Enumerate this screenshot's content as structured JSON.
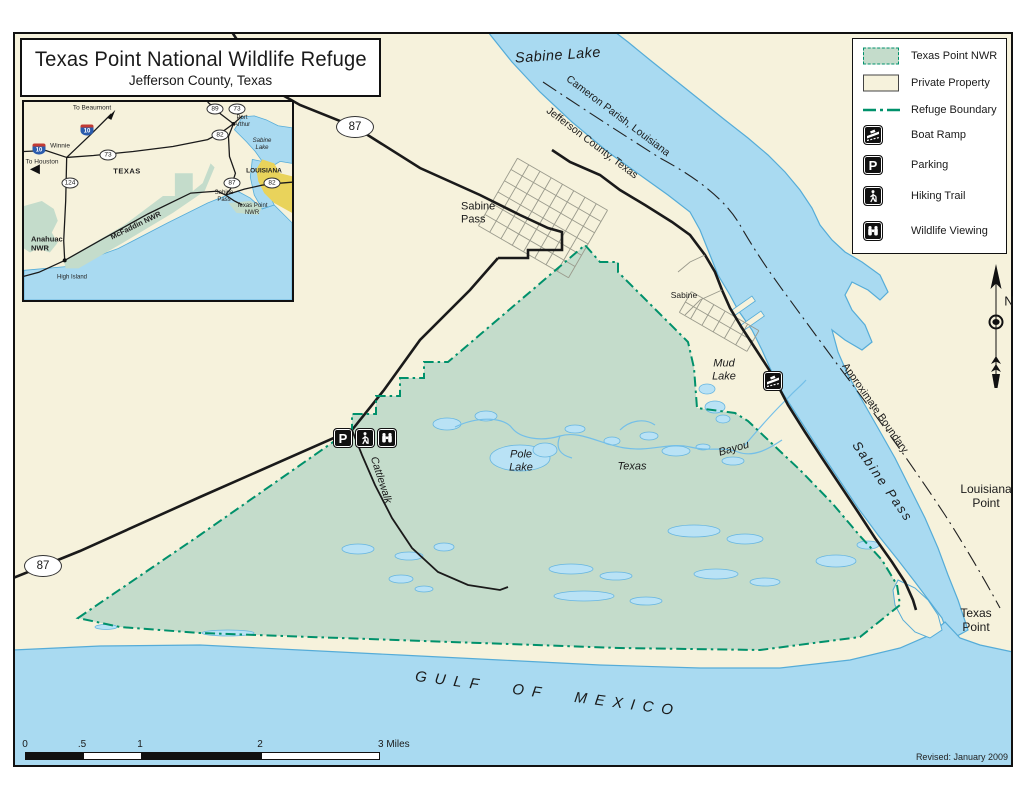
{
  "title": {
    "line1": "Texas Point National Wildlife Refuge",
    "line2": "Jefferson County, Texas"
  },
  "legend": {
    "items": [
      {
        "label": "Texas Point NWR"
      },
      {
        "label": "Private Property"
      },
      {
        "label": "Refuge Boundary"
      },
      {
        "label": "Boat Ramp"
      },
      {
        "label": "Parking"
      },
      {
        "label": "Hiking Trail"
      },
      {
        "label": "Wildlife Viewing"
      }
    ]
  },
  "compass": {
    "north_label": "N"
  },
  "scale_bar": {
    "ticks": [
      "0",
      ".5",
      "1",
      "2"
    ],
    "end_label": "3 Miles"
  },
  "icons": {
    "parking_glyph": "P"
  },
  "map": {
    "labels": {
      "sabine_lake": "Sabine Lake",
      "cameron_parish": "Cameron Parish, Louisiana",
      "jefferson_county": "Jefferson County, Texas",
      "sabine_pass_town": "Sabine Pass",
      "sabine_town": "Sabine",
      "mud_lake": "Mud Lake",
      "pole_lake": "Pole Lake",
      "texas_bayou_word1": "Texas",
      "texas_bayou_word2": "Bayou",
      "cattlewalk": "Cattlewalk",
      "approximate_boundary": "Approximate Boundary",
      "sabine_pass_water": "Sabine Pass",
      "louisiana_point": "Louisiana Point",
      "texas_point": "Texas Point",
      "gulf_of_mexico": "GULF  OF  MEXICO",
      "route_87": "87",
      "revised": "Revised: January 2009"
    }
  },
  "inset": {
    "labels": {
      "to_beaumont": "To Beaumont",
      "to_houston": "To Houston",
      "winnie": "Winnie",
      "texas": "TEXAS",
      "louisiana": "LOUISIANA",
      "port_arthur": "Port Arthur",
      "sabine_lake": "Sabine Lake",
      "sabine_pass": "Sabine Pass",
      "texas_point_nwr": "Texas Point NWR",
      "mcfaddin_nwr": "McFaddin NWR",
      "anahuac_nwr": "Anahuac NWR",
      "high_island": "High Island",
      "i10": "10",
      "route_73": "73",
      "route_124": "124",
      "route_89": "89",
      "route_82": "82",
      "route_87": "87"
    }
  },
  "colors": {
    "cream": "#F6F2DC",
    "water": "#A9DAF1",
    "refuge_green": "#C4DCCB",
    "boundary_green": "#00916B",
    "louisiana_yellow": "#E9D35B"
  }
}
